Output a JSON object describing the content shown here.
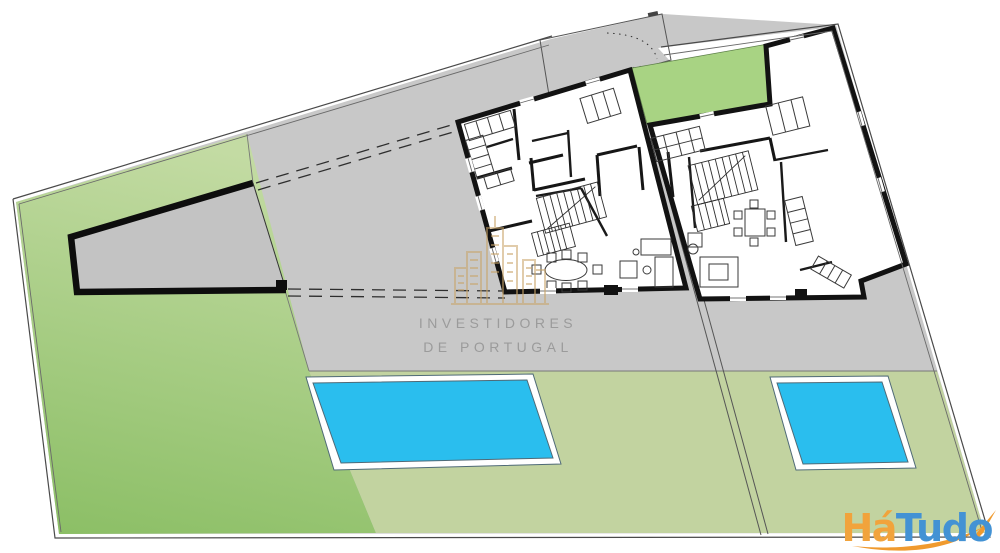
{
  "plan": {
    "colors": {
      "background": "#ffffff",
      "paving": "#c8c8c8",
      "annex_fill": "#c3c3c3",
      "grass_light": "#c3dba3",
      "grass_dark": "#8cbf66",
      "lawn": "#c2d3a0",
      "courtyard": "#a8d383",
      "pool_water": "#2abeee",
      "pool_border": "#ffffff",
      "house_fill": "#ffffff",
      "wall": "#121212"
    }
  },
  "watermark": {
    "icon": "buildings-skyline-icon",
    "line1": "INVESTIDORES",
    "line2": "DE PORTUGAL",
    "text_color": "#9b9b9b",
    "icon_color": "#c9a468"
  },
  "logo": {
    "text_part1": "Há",
    "text_part2": "Tudo",
    "part1_color": "#f1a33c",
    "part2_color": "#4392d4",
    "swoosh_color": "#f09a2e",
    "icon": "swoosh-arrow-icon"
  }
}
